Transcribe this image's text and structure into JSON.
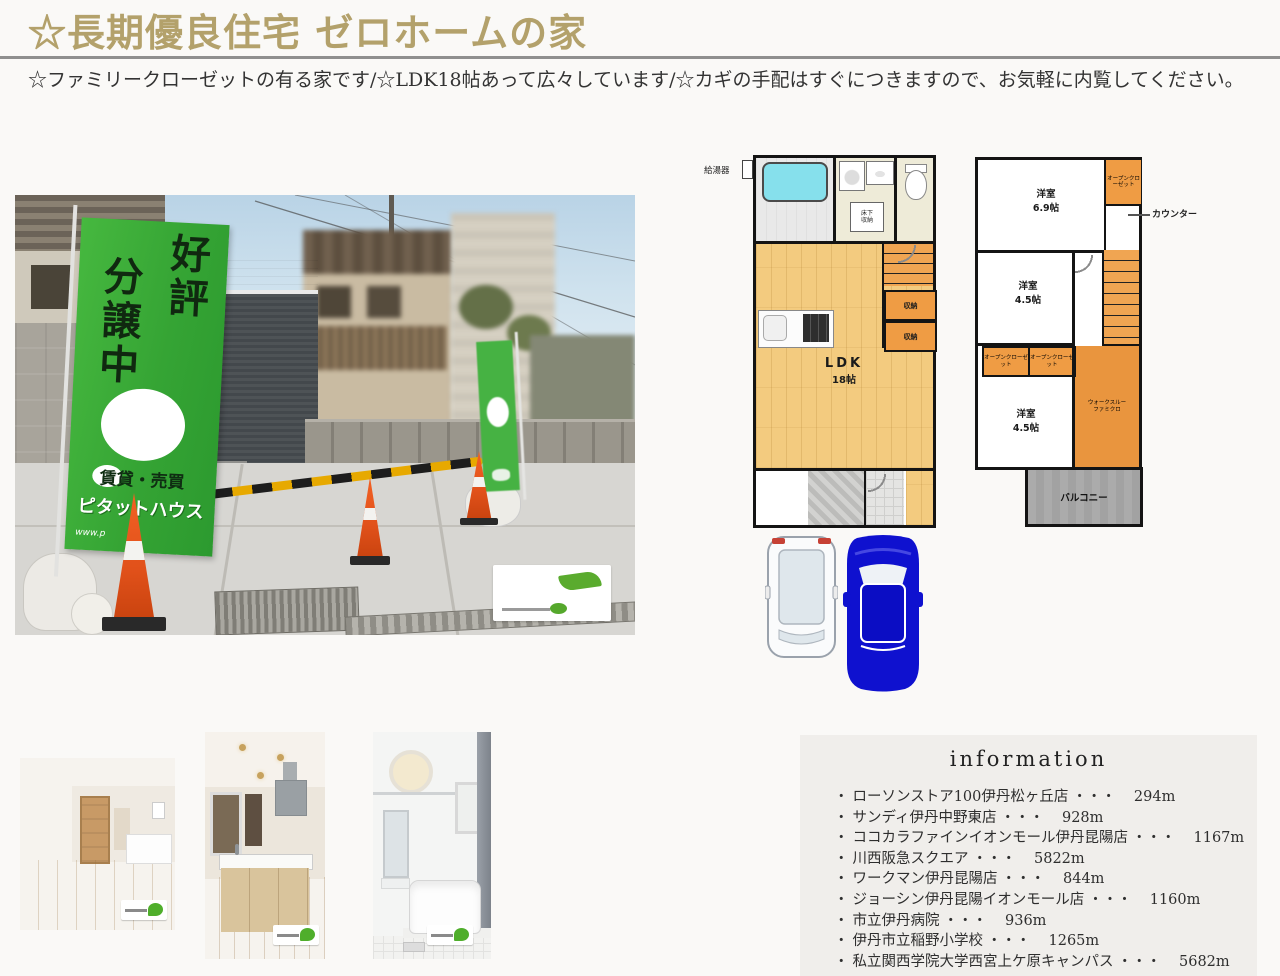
{
  "header": {
    "title": "☆長期優良住宅 ゼロホームの家",
    "subtitle": "☆ファミリークローゼットの有る家です/☆LDK18帖あって広々しています/☆カギの手配はすぐにつきますので、お気軽に内覧してください。"
  },
  "exterior_photo": {
    "banner": {
      "col_right": "好評",
      "col_left": "分譲中",
      "line_rental": "賃貸・売買",
      "brand": "ピタットハウス",
      "url": "www.p"
    }
  },
  "floorplan_1f": {
    "water_heater": "給湯器",
    "underfloor_storage": "床下収納",
    "ldk_name": "LDK",
    "ldk_size": "18帖",
    "storage1": "収納",
    "storage2": "収納"
  },
  "floorplan_2f": {
    "room1_name": "洋室",
    "room1_size": "6.9帖",
    "open_closet_top": "オープンクローゼット",
    "counter": "カウンター",
    "room2_name": "洋室",
    "room2_size": "4.5帖",
    "open_closet_a": "オープンクローゼット",
    "open_closet_b": "オープンクローゼット",
    "room3_name": "洋室",
    "room3_size": "4.5帖",
    "famiclo_line1": "ウォークスルー",
    "famiclo_line2": "ファミクロ",
    "balcony": "バルコニー"
  },
  "info": {
    "title": "information",
    "bullet": "・",
    "dots": "・・・",
    "items": [
      {
        "name": "ローソンストア100伊丹松ヶ丘店",
        "distance": "294m"
      },
      {
        "name": "サンディ伊丹中野東店",
        "distance": "928m"
      },
      {
        "name": "ココカラファインイオンモール伊丹昆陽店",
        "distance": "1167m"
      },
      {
        "name": "川西阪急スクエア",
        "distance": "5822m"
      },
      {
        "name": "ワークマン伊丹昆陽店",
        "distance": "844m"
      },
      {
        "name": "ジョーシン伊丹昆陽イオンモール店",
        "distance": "1160m"
      },
      {
        "name": "市立伊丹病院",
        "distance": "936m"
      },
      {
        "name": "伊丹市立稲野小学校",
        "distance": "1265m"
      },
      {
        "name": "私立関西学院大学西宮上ケ原キャンパス",
        "distance": "5682m"
      }
    ]
  },
  "colors": {
    "title_gold": "#b3a16b",
    "banner_green": "#3db33d",
    "plan_wood": "#f3cb7f",
    "plan_orange": "#ef9c44",
    "tub_cyan": "#86e0ec",
    "car_blue": "#0f11cf",
    "cone_orange": "#e8581e",
    "info_bg": "#f0eeeb"
  }
}
